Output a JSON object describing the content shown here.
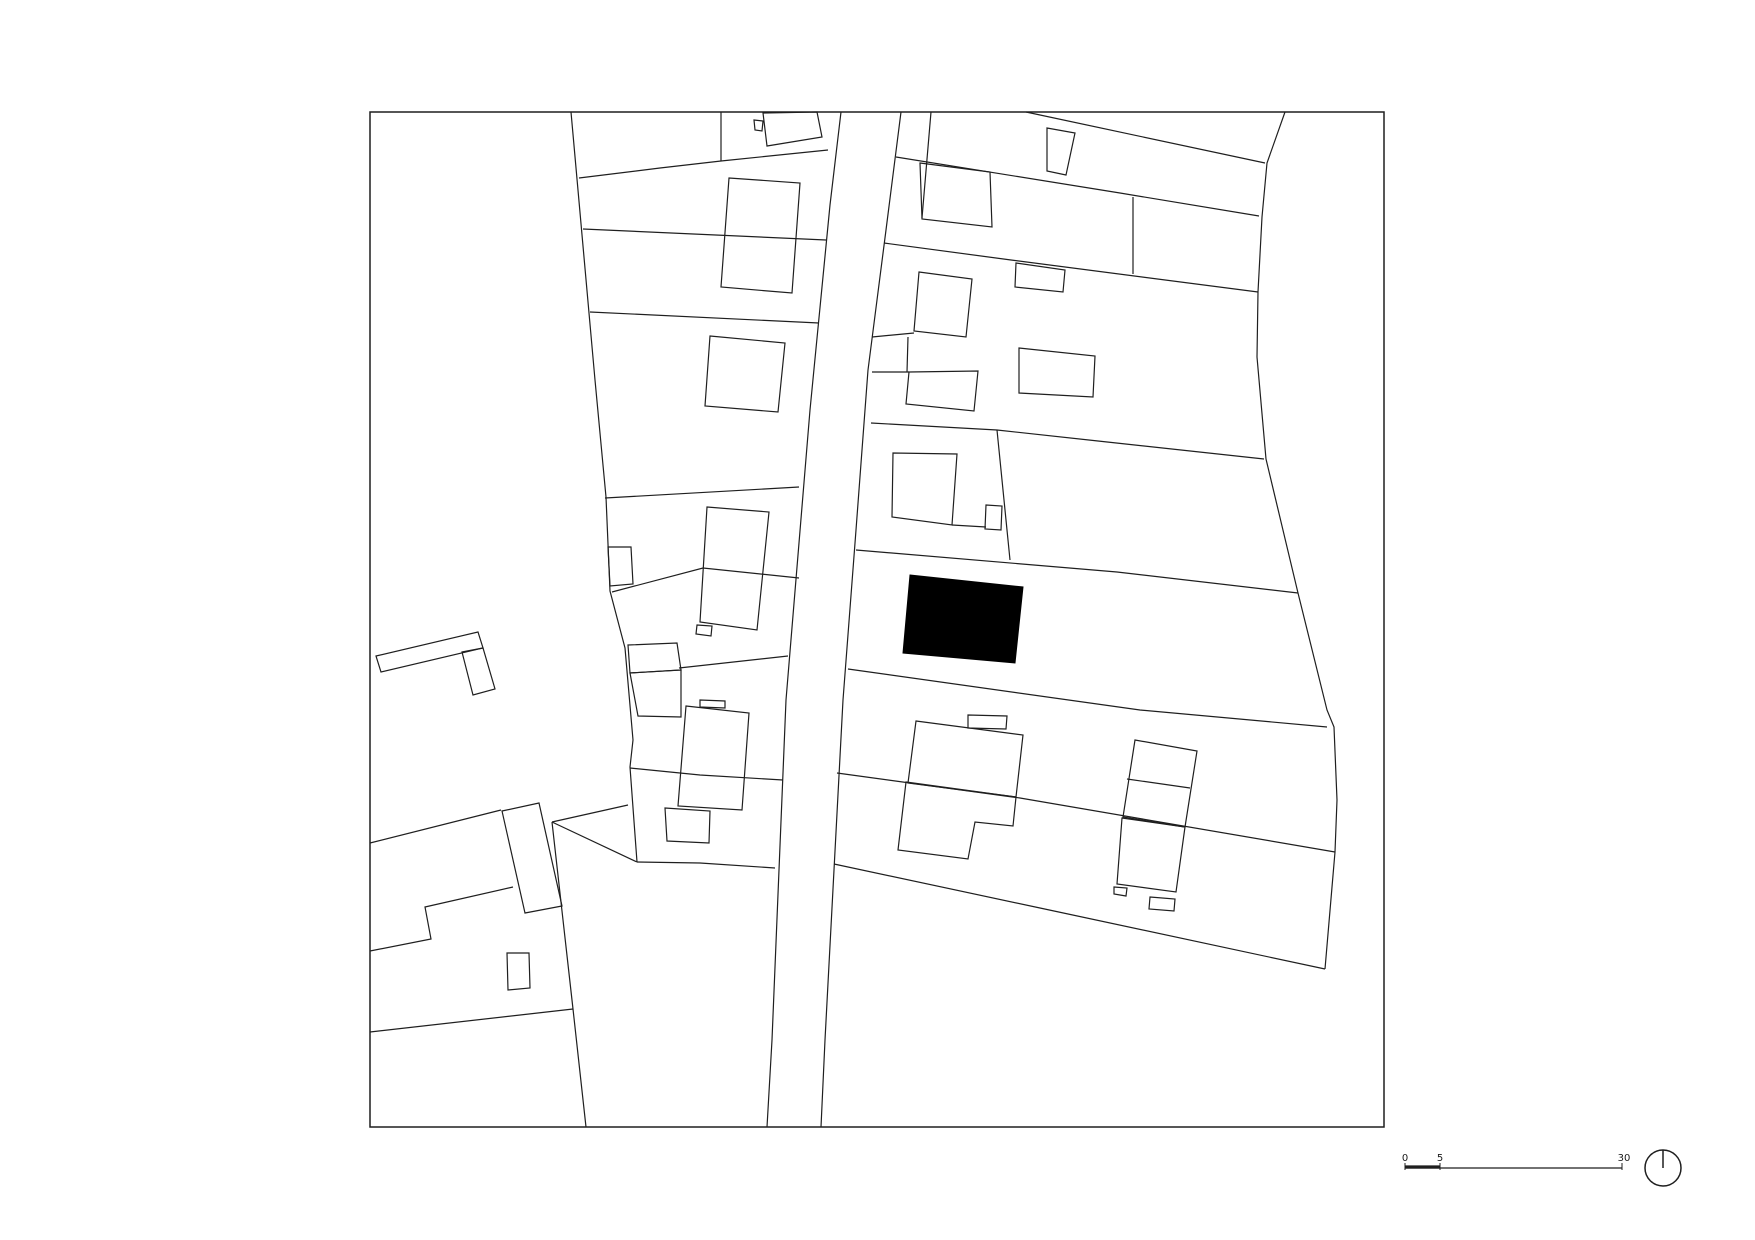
{
  "meta": {
    "drawing_type": "architectural figure-ground site plan",
    "background_color": "#ffffff",
    "line_color": "#1f1f1f",
    "subject_fill_color": "#000000"
  },
  "canvas": {
    "width": 1755,
    "height": 1240
  },
  "plan": {
    "frame": {
      "x": 370,
      "y": 112,
      "w": 1014,
      "h": 1015
    },
    "road": {
      "left_edge": [
        [
          841,
          112
        ],
        [
          830,
          205
        ],
        [
          810,
          410
        ],
        [
          786,
          700
        ],
        [
          772,
          1040
        ],
        [
          767,
          1127
        ]
      ],
      "right_edge": [
        [
          901,
          112
        ],
        [
          886,
          230
        ],
        [
          868,
          370
        ],
        [
          856,
          530
        ],
        [
          843,
          700
        ],
        [
          825,
          1040
        ],
        [
          821,
          1127
        ]
      ]
    },
    "village_edge": [
      [
        1285,
        112
      ],
      [
        1267,
        163
      ],
      [
        1262,
        217
      ],
      [
        1258,
        292
      ],
      [
        1257,
        357
      ],
      [
        1266,
        459
      ],
      [
        1298,
        593
      ],
      [
        1327,
        710
      ],
      [
        1334,
        727
      ],
      [
        1337,
        800
      ],
      [
        1335,
        852
      ],
      [
        1325,
        969
      ]
    ],
    "parcel_lines": [
      [
        [
          571,
          112
        ],
        [
          595,
          380
        ],
        [
          606,
          497
        ],
        [
          610,
          591
        ],
        [
          625,
          648
        ],
        [
          633,
          740
        ],
        [
          630,
          767
        ],
        [
          637,
          862
        ]
      ],
      [
        [
          579,
          178
        ],
        [
          660,
          168
        ],
        [
          721,
          161
        ],
        [
          828,
          150
        ]
      ],
      [
        [
          721,
          112
        ],
        [
          721,
          161
        ]
      ],
      [
        [
          583,
          229
        ],
        [
          826,
          240
        ]
      ],
      [
        [
          590,
          312
        ],
        [
          819,
          323
        ]
      ],
      [
        [
          605,
          498
        ],
        [
          799,
          487
        ]
      ],
      [
        [
          612,
          592
        ],
        [
          703,
          568
        ],
        [
          799,
          578
        ]
      ],
      [
        [
          679,
          668
        ],
        [
          788,
          656
        ]
      ],
      [
        [
          630,
          768
        ],
        [
          700,
          775
        ],
        [
          783,
          780
        ]
      ],
      [
        [
          637,
          862
        ],
        [
          700,
          863
        ],
        [
          775,
          868
        ]
      ],
      [
        [
          552,
          822
        ],
        [
          628,
          805
        ]
      ],
      [
        [
          552,
          822
        ],
        [
          637,
          862
        ]
      ],
      [
        [
          552,
          822
        ],
        [
          573,
          1009
        ],
        [
          586,
          1127
        ]
      ],
      [
        [
          370,
          1032
        ],
        [
          573,
          1009
        ]
      ],
      [
        [
          370,
          843
        ],
        [
          501,
          810
        ]
      ],
      [
        [
          370,
          951
        ],
        [
          431,
          939
        ],
        [
          425,
          907
        ],
        [
          513,
          887
        ]
      ],
      [
        [
          896,
          157
        ],
        [
          1120,
          193
        ],
        [
          1259,
          216
        ]
      ],
      [
        [
          931,
          112
        ],
        [
          922,
          218
        ]
      ],
      [
        [
          1026,
          112
        ],
        [
          1265,
          163
        ]
      ],
      [
        [
          884,
          243
        ],
        [
          1011,
          260
        ],
        [
          1258,
          292
        ]
      ],
      [
        [
          1133,
          197
        ],
        [
          1133,
          274
        ]
      ],
      [
        [
          872,
          337
        ],
        [
          914,
          333
        ]
      ],
      [
        [
          908,
          337
        ],
        [
          907,
          372
        ]
      ],
      [
        [
          872,
          372
        ],
        [
          909,
          372
        ]
      ],
      [
        [
          871,
          423
        ],
        [
          997,
          430
        ],
        [
          1098,
          441
        ],
        [
          1264,
          459
        ]
      ],
      [
        [
          997,
          430
        ],
        [
          1010,
          560
        ]
      ],
      [
        [
          856,
          550
        ],
        [
          1117,
          572
        ],
        [
          1298,
          593
        ]
      ],
      [
        [
          848,
          669
        ],
        [
          1140,
          710
        ],
        [
          1327,
          727
        ]
      ],
      [
        [
          837,
          773
        ],
        [
          1020,
          798
        ],
        [
          1335,
          852
        ]
      ],
      [
        [
          834,
          864
        ],
        [
          1040,
          908
        ],
        [
          1325,
          969
        ]
      ],
      [
        [
          952,
          525
        ],
        [
          986,
          527
        ]
      ],
      [
        [
          1127,
          779
        ],
        [
          1190,
          788
        ]
      ]
    ],
    "buildings": [
      [
        [
          763,
          113
        ],
        [
          817,
          112
        ],
        [
          822,
          137
        ],
        [
          767,
          146
        ]
      ],
      [
        [
          754,
          120
        ],
        [
          763,
          121
        ],
        [
          762,
          131
        ],
        [
          755,
          130
        ]
      ],
      [
        [
          729,
          178
        ],
        [
          800,
          183
        ],
        [
          792,
          293
        ],
        [
          721,
          287
        ]
      ],
      [
        [
          710,
          336
        ],
        [
          785,
          343
        ],
        [
          778,
          412
        ],
        [
          705,
          406
        ]
      ],
      [
        [
          707,
          507
        ],
        [
          769,
          512
        ],
        [
          757,
          630
        ],
        [
          700,
          622
        ]
      ],
      [
        [
          697,
          625
        ],
        [
          712,
          626
        ],
        [
          711,
          636
        ],
        [
          696,
          634
        ]
      ],
      [
        [
          608,
          547
        ],
        [
          631,
          547
        ],
        [
          633,
          584
        ],
        [
          610,
          586
        ]
      ],
      [
        [
          628,
          645
        ],
        [
          677,
          643
        ],
        [
          681,
          670
        ],
        [
          630,
          673
        ]
      ],
      [
        [
          630,
          673
        ],
        [
          681,
          670
        ],
        [
          681,
          717
        ],
        [
          638,
          716
        ]
      ],
      [
        [
          686,
          706
        ],
        [
          749,
          713
        ],
        [
          742,
          810
        ],
        [
          678,
          806
        ]
      ],
      [
        [
          700,
          700
        ],
        [
          725,
          701
        ],
        [
          725,
          708
        ],
        [
          700,
          707
        ]
      ],
      [
        [
          665,
          808
        ],
        [
          710,
          811
        ],
        [
          709,
          843
        ],
        [
          667,
          841
        ]
      ],
      [
        [
          376,
          656
        ],
        [
          478,
          632
        ],
        [
          483,
          648
        ],
        [
          381,
          672
        ]
      ],
      [
        [
          462,
          652
        ],
        [
          483,
          648
        ],
        [
          495,
          689
        ],
        [
          473,
          695
        ]
      ],
      [
        [
          502,
          811
        ],
        [
          539,
          803
        ],
        [
          562,
          906
        ],
        [
          525,
          913
        ]
      ],
      [
        [
          507,
          953
        ],
        [
          529,
          953
        ],
        [
          530,
          988
        ],
        [
          508,
          990
        ]
      ],
      [
        [
          920,
          163
        ],
        [
          990,
          172
        ],
        [
          992,
          227
        ],
        [
          922,
          219
        ]
      ],
      [
        [
          1047,
          128
        ],
        [
          1075,
          133
        ],
        [
          1066,
          175
        ],
        [
          1047,
          171
        ]
      ],
      [
        [
          1016,
          263
        ],
        [
          1065,
          270
        ],
        [
          1063,
          292
        ],
        [
          1015,
          287
        ]
      ],
      [
        [
          919,
          272
        ],
        [
          972,
          279
        ],
        [
          966,
          337
        ],
        [
          914,
          331
        ]
      ],
      [
        [
          1019,
          348
        ],
        [
          1095,
          356
        ],
        [
          1093,
          397
        ],
        [
          1019,
          393
        ]
      ],
      [
        [
          909,
          372
        ],
        [
          978,
          371
        ],
        [
          974,
          411
        ],
        [
          906,
          404
        ]
      ],
      [
        [
          893,
          453
        ],
        [
          957,
          454
        ],
        [
          952,
          525
        ],
        [
          892,
          517
        ]
      ],
      [
        [
          986,
          505
        ],
        [
          1002,
          506
        ],
        [
          1001,
          530
        ],
        [
          985,
          529
        ]
      ],
      [
        [
          916,
          721
        ],
        [
          1023,
          735
        ],
        [
          1016,
          797
        ],
        [
          908,
          783
        ]
      ],
      [
        [
          906,
          782
        ],
        [
          1016,
          797
        ],
        [
          1013,
          826
        ],
        [
          975,
          822
        ],
        [
          968,
          859
        ],
        [
          898,
          850
        ]
      ],
      [
        [
          968,
          715
        ],
        [
          1007,
          716
        ],
        [
          1006,
          729
        ],
        [
          968,
          728
        ]
      ],
      [
        [
          1135,
          740
        ],
        [
          1197,
          751
        ],
        [
          1185,
          827
        ],
        [
          1123,
          817
        ]
      ],
      [
        [
          1122,
          818
        ],
        [
          1185,
          827
        ],
        [
          1176,
          892
        ],
        [
          1117,
          884
        ]
      ],
      [
        [
          1114,
          887
        ],
        [
          1127,
          888
        ],
        [
          1126,
          896
        ],
        [
          1114,
          894
        ]
      ],
      [
        [
          1150,
          897
        ],
        [
          1175,
          899
        ],
        [
          1174,
          911
        ],
        [
          1149,
          909
        ]
      ]
    ],
    "subject_building": [
      [
        910,
        575
      ],
      [
        1023,
        587
      ],
      [
        1015,
        663
      ],
      [
        903,
        653
      ]
    ]
  },
  "scale_bar": {
    "labels": [
      "0",
      "5",
      "30"
    ],
    "label_x": [
      1405,
      1440,
      1624
    ],
    "label_y": 1161,
    "bar_y": 1168,
    "x_start": 1405,
    "x_mid": 1440,
    "x_end": 1622
  },
  "north_arrow": {
    "cx": 1663,
    "cy": 1168,
    "r": 18
  }
}
